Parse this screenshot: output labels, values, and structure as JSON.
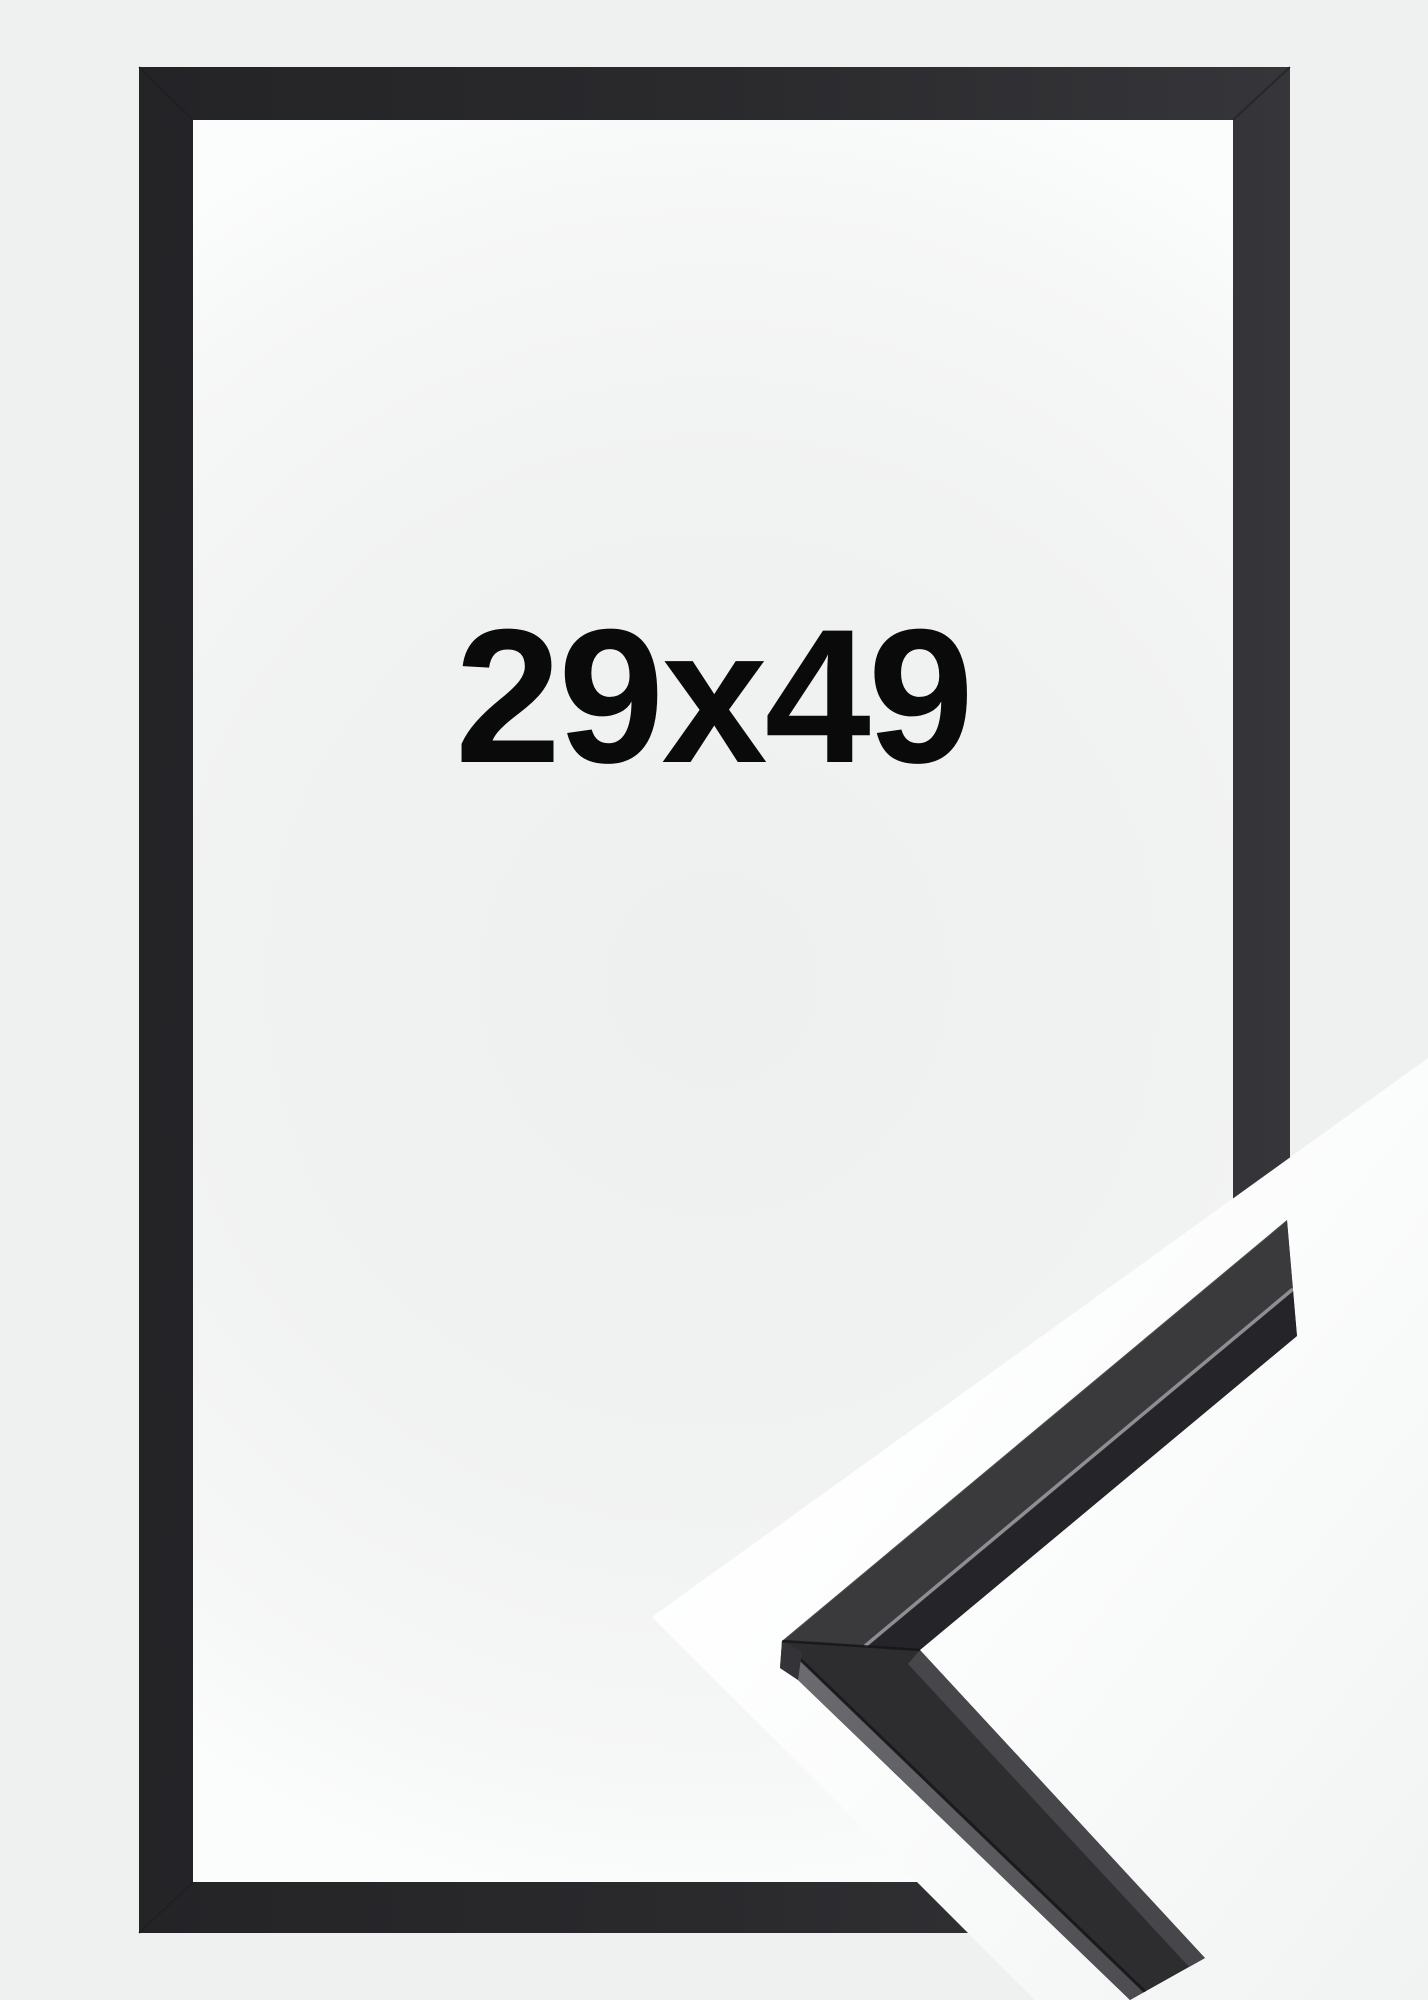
{
  "frame_photo": {
    "size_label": "29x49",
    "colors": {
      "page_background": "#eff0f0",
      "frame": "#2a2a2d",
      "interior_center": "#eef0f0",
      "interior_edge": "#fbfcfc",
      "detail_backdrop": "#ffffff",
      "label_text": "#0a0a0b",
      "moulding_front_face": "#2d2d30",
      "moulding_top_face": "#3a3a3c",
      "moulding_lip_face": "#252529",
      "moulding_arris_highlight": "#93939a"
    }
  }
}
